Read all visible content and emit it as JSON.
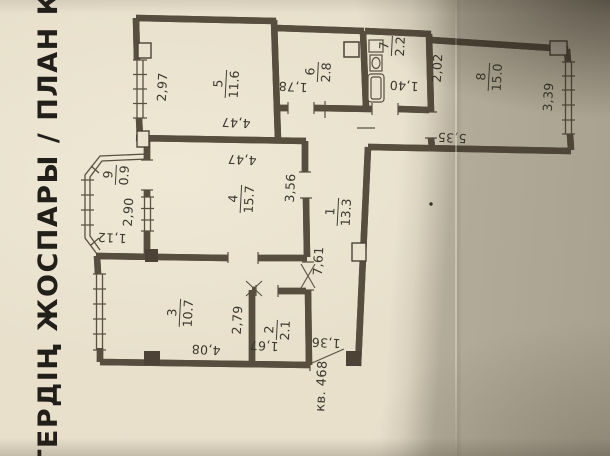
{
  "photo": {
    "paper_color": "#e8e0cb",
    "ink_color": "#4c4336",
    "shadow_color": "#3a3226"
  },
  "title": {
    "text": "ТЕРДІҢ ЖОСПАРЫ / ПЛАН КВАРТИ"
  },
  "apartment": {
    "label": "кв. 468"
  },
  "plan": {
    "rooms": [
      {
        "number": "1",
        "area": "13.3",
        "x": 338,
        "y": 212
      },
      {
        "number": "2",
        "area": "2.1",
        "x": 277,
        "y": 330
      },
      {
        "number": "3",
        "area": "10.7",
        "x": 180,
        "y": 313
      },
      {
        "number": "4",
        "area": "15.7",
        "x": 241,
        "y": 199
      },
      {
        "number": "5",
        "area": "11.6",
        "x": 226,
        "y": 84
      },
      {
        "number": "6",
        "area": "2.8",
        "x": 318,
        "y": 72
      },
      {
        "number": "7",
        "area": "2.2",
        "x": 392,
        "y": 46
      },
      {
        "number": "8",
        "area": "15.0",
        "x": 489,
        "y": 77
      },
      {
        "number": "9",
        "area": "0.9",
        "x": 116,
        "y": 175
      }
    ],
    "dimensions": [
      {
        "text": "2,97",
        "x": 162,
        "y": 87,
        "rot": -90
      },
      {
        "text": "4,47",
        "x": 236,
        "y": 123,
        "rot": 180
      },
      {
        "text": "4,47",
        "x": 242,
        "y": 160,
        "rot": 180
      },
      {
        "text": "3,56",
        "x": 290,
        "y": 188,
        "rot": -90
      },
      {
        "text": "1,78",
        "x": 293,
        "y": 87,
        "rot": 180
      },
      {
        "text": "1,40",
        "x": 404,
        "y": 86,
        "rot": 180
      },
      {
        "text": "2,02",
        "x": 437,
        "y": 68,
        "rot": -90
      },
      {
        "text": "3,39",
        "x": 548,
        "y": 97,
        "rot": -90
      },
      {
        "text": "5,35",
        "x": 452,
        "y": 138,
        "rot": 180
      },
      {
        "text": "2,90",
        "x": 128,
        "y": 212,
        "rot": -90
      },
      {
        "text": "1,12",
        "x": 112,
        "y": 238,
        "rot": 180
      },
      {
        "text": "7,61",
        "x": 318,
        "y": 261,
        "rot": -90
      },
      {
        "text": "2,79",
        "x": 237,
        "y": 320,
        "rot": -90
      },
      {
        "text": "4,08",
        "x": 206,
        "y": 350,
        "rot": 180
      },
      {
        "text": "1,67",
        "x": 264,
        "y": 346,
        "rot": 180
      },
      {
        "text": "1,36",
        "x": 326,
        "y": 343,
        "rot": 180
      }
    ]
  }
}
